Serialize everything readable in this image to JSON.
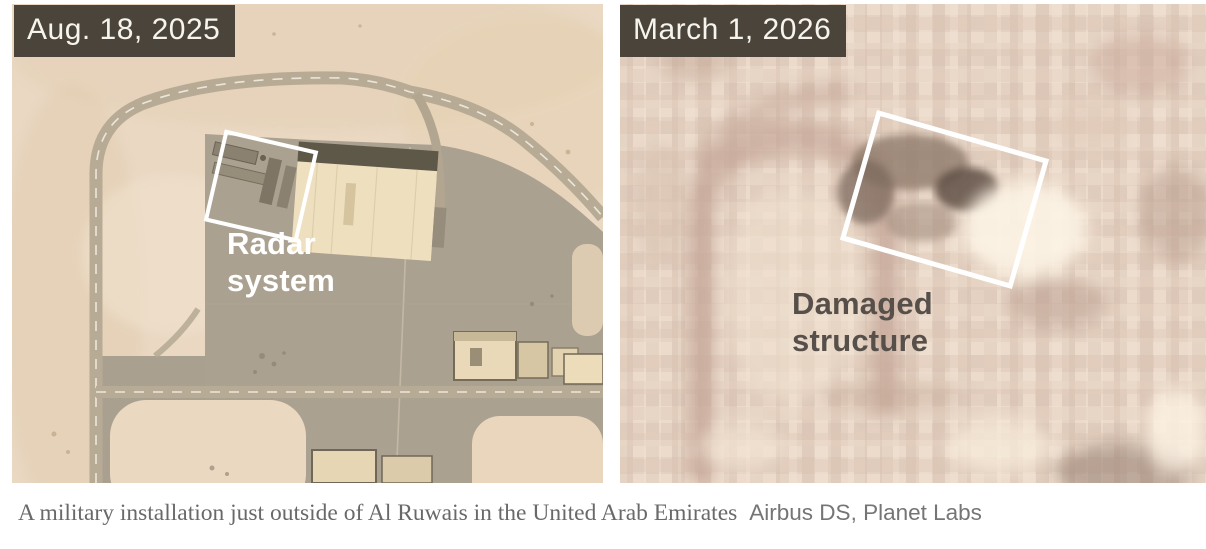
{
  "panels": {
    "before": {
      "date": "Aug. 18, 2025",
      "annotation": "Radar\nsystem"
    },
    "after": {
      "date": "March 1, 2026",
      "annotation": "Damaged\nstructure"
    }
  },
  "caption": {
    "text": "A military installation just outside of Al Ruwais in the United Arab Emirates",
    "credit": "Airbus DS, Planet Labs"
  },
  "colors": {
    "date_chip_bg": "#4b443a",
    "date_chip_text": "#f7f4ee",
    "annotation_light_text": "#ffffff",
    "annotation_dark_text": "#57504a",
    "highlight_box": "#ffffff",
    "desert_sand": "#ead8c3",
    "pavement": "#aba191",
    "after_image_tint": "#e9d5c5",
    "caption_text": "#696969"
  }
}
